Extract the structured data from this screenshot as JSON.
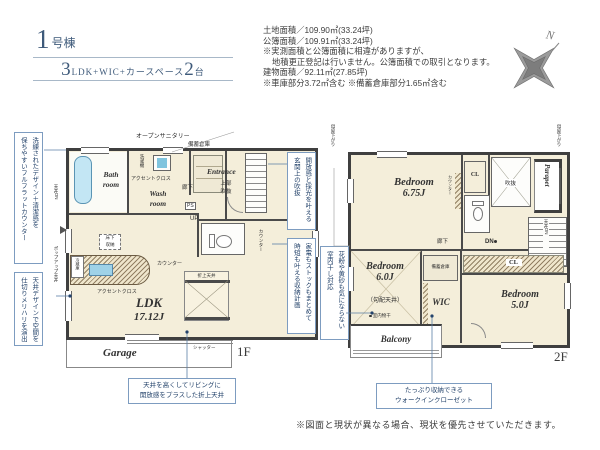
{
  "colors": {
    "title_navy": "#3e5a7a",
    "callout_navy": "#24436b",
    "callout_border": "#7d9cc0",
    "room_cream": "#f4eeda",
    "wall_dark": "#3f3f3f",
    "tub_blue": "#c3e6f4",
    "leader_blue": "#5b7fa6"
  },
  "header": {
    "unit": {
      "number": "1",
      "suffix": "号棟"
    },
    "layout": {
      "n1": "3",
      "mid": "LDK+WIC+カースペース",
      "n2": "2",
      "tail": "台"
    },
    "details": [
      "土地面積／109.90㎡(33.24坪)",
      "公簿面積／109.91㎡(33.24坪)",
      "※実測面積と公簿面積に相違がありますが、",
      "地積更正登記は行いません。公簿面積での取引となります。",
      "建物面積／92.11㎡(27.85坪)",
      "※車庫部分3.72㎡含む ※備蓄倉庫部分1.65㎡含む"
    ]
  },
  "compass": {
    "north": "N"
  },
  "floor1": {
    "label": "1F",
    "open_sanitary": "オープンサニタリー",
    "stock_storage": "備蓄倉庫",
    "bath": {
      "l1": "Bath",
      "l2": "room"
    },
    "wash": {
      "l1": "Wash",
      "l2": "room"
    },
    "accent_cloth_wash": "アクセントクロス",
    "washer": "洗濯機",
    "entrance": "Entrance",
    "upper_void": {
      "l1": "上部",
      "l2": "吹抜"
    },
    "hallway": "廊下",
    "ps": "PS",
    "up": "UP",
    "counter_stairs": "カウンター",
    "fridge": "冷蔵庫",
    "floor_storage": {
      "l1": "床下",
      "l2": "収納"
    },
    "counter_kitchen": "カウンター",
    "accent_cloth_kitchen": "アクセントクロス",
    "ldk": {
      "name": "LDK",
      "size": "17.12J"
    },
    "coffered": "折上天井",
    "garage": "Garage",
    "shutter": "シャッター",
    "ceiling_dn": "天井DN",
    "popup_ceiling": "ポップアップ天井"
  },
  "floor2": {
    "label": "2F",
    "moya_left": "母屋下がり",
    "moya_right": "母屋下がり",
    "bedroom1": {
      "name": "Bedroom",
      "size": "6.75J"
    },
    "counter": "カウンター",
    "cl_top": "CL",
    "cl_right": "CL",
    "void": "吹抜",
    "parapet": "Parapet",
    "hallway": "廊下",
    "dn": "DN",
    "ceiling_dn": "天井DN",
    "bedroom2": {
      "name": "Bedroom",
      "size": "6.0J",
      "note": "（勾配天井）"
    },
    "indoor_drying": "室内物干",
    "stock_storage": "備蓄倉庫",
    "wic": "WIC",
    "bedroom3": {
      "name": "Bedroom",
      "size": "5.0J"
    },
    "balcony": "Balcony"
  },
  "callouts": {
    "flat_counter": {
      "l1": "洗練されたデザイン＋清潔感を",
      "l2": "保ちやすいフルフラットカウンター"
    },
    "ceiling_design": {
      "l1": "天井デザインで空間を",
      "l2": "仕切りメリハリを演出"
    },
    "coffered": {
      "l1": "天井を高くしてリビングに",
      "l2": "開放感をプラスした折上天井"
    },
    "entrance_void": {
      "l1": "開放感と採光を叶える",
      "l2": "玄関上の吹抜"
    },
    "storage_plan": {
      "l1": "家電もストックもまとめて",
      "l2": "時短も叶える収納計画"
    },
    "indoor_drying": {
      "l1": "花粉や黄砂も気にならない",
      "l2": "室内干し対応"
    },
    "wic": {
      "l1": "たっぷり収納できる",
      "l2": "ウォークインクローゼット"
    }
  },
  "footer": {
    "disclaimer": "※図面と現状が異なる場合、現状を優先させていただきます。"
  }
}
